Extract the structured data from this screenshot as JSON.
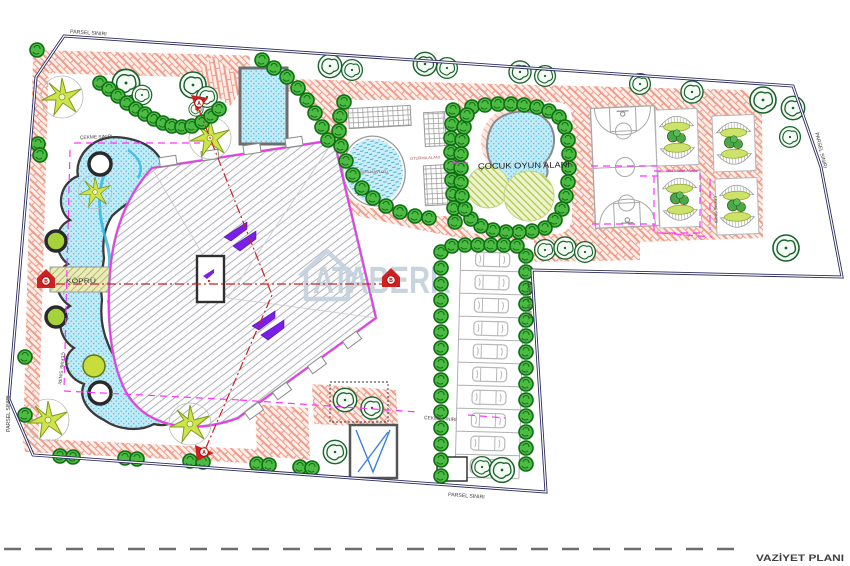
{
  "title": "VAZİYET PLANI",
  "watermark": "ATABERK",
  "labels": {
    "parsel_siniri": "PARSEL SINIRI",
    "cekme_siniri": "ÇEKME SINIRI",
    "kopru": "KÖPRÜ",
    "sus_havuzu": "SÜS HAVUZU",
    "oturma_alani": "OTURMA ALANI",
    "cocuk_oyun_alani": "ÇOCUK OYUN ALANI"
  },
  "section_markers": {
    "a": "A",
    "b": "B"
  },
  "counts": {
    "parking_stalls": 10,
    "seating_pergolas": 4,
    "basketball_courts": 1
  },
  "colors": {
    "parcel_border": "#2b2b5e",
    "brick_paving": "#ef9d8a",
    "pool_water": "#bfeaf6",
    "setback_line": "#ff35ff",
    "section_line": "#cc2222",
    "shrub_green": "#4cbb44",
    "palm_green": "#cfe34c",
    "building_edge": "#ff2bff",
    "bridge_fill": "#e9ecb9",
    "watermark_blue": "#c3d0dd"
  }
}
